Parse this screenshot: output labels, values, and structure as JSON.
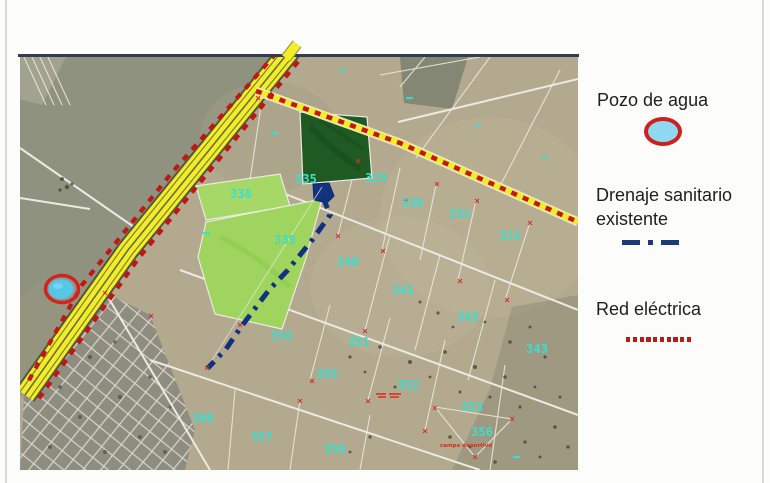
{
  "legend": {
    "items": [
      {
        "label": "Pozo de agua",
        "icon": "water-well-icon"
      },
      {
        "label": "Drenaje sanitario existente",
        "icon": "dash-dot-line-icon"
      },
      {
        "label": "Red eléctrica",
        "icon": "dotted-line-icon"
      }
    ]
  },
  "map": {
    "parcels": [
      {
        "n": "335"
      },
      {
        "n": "329"
      },
      {
        "n": "330"
      },
      {
        "n": "331"
      },
      {
        "n": "332"
      },
      {
        "n": "338"
      },
      {
        "n": "339"
      },
      {
        "n": "340"
      },
      {
        "n": "341"
      },
      {
        "n": "342"
      },
      {
        "n": "343"
      },
      {
        "n": "350"
      },
      {
        "n": "351"
      },
      {
        "n": "352"
      },
      {
        "n": "353"
      },
      {
        "n": "355"
      },
      {
        "n": "356"
      },
      {
        "n": "357"
      },
      {
        "n": "358"
      },
      {
        "n": "360"
      }
    ],
    "annotations": [
      {
        "text": "campo deportivo"
      }
    ],
    "colors": {
      "highway_yellow": "#f1ed26",
      "electric_red": "#c41414",
      "drainage_blue": "#12307e",
      "parcel_number_cyan": "#38dfce",
      "well_fill": "#8ed9f0",
      "well_ring": "#cf1f1f",
      "parcel_green_light": "#a6d868",
      "parcel_green_dark": "#1e5a22"
    }
  }
}
